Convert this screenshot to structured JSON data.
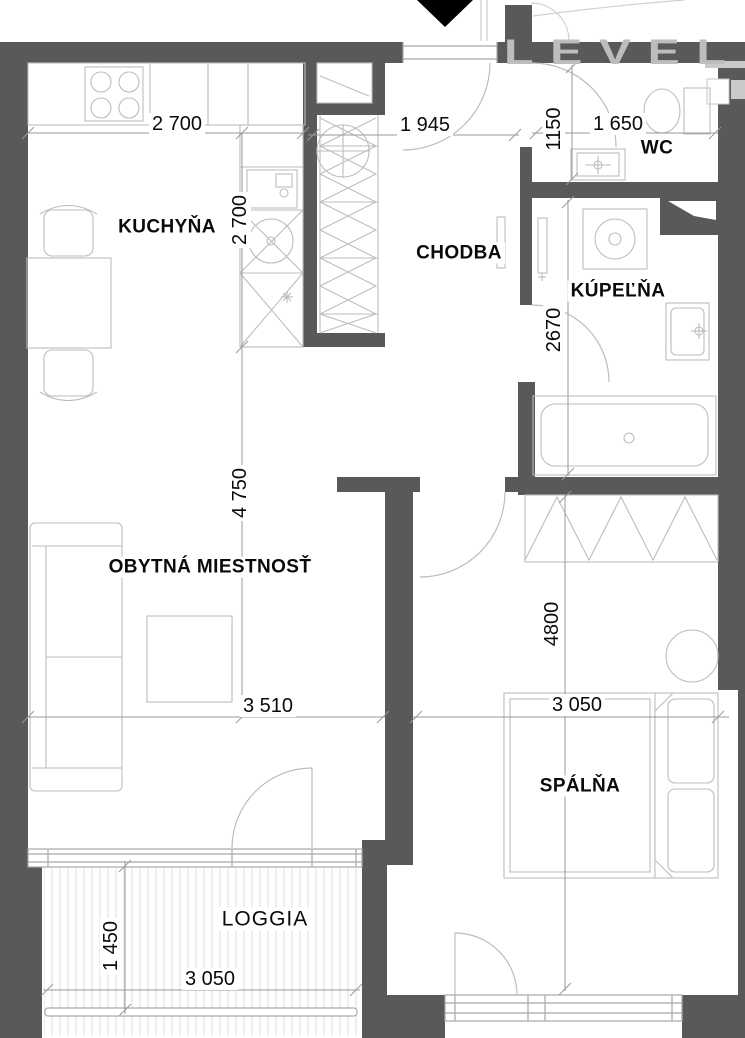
{
  "watermark": {
    "text": "LEVEL"
  },
  "entrance": {
    "marker_shape": "down-triangle"
  },
  "rooms": {
    "kuchyna": {
      "label": "KUCHYŇA"
    },
    "chodba": {
      "label": "CHODBA"
    },
    "wc": {
      "label": "WC"
    },
    "kupelna": {
      "label": "KÚPEĽŇA"
    },
    "obytna_miestnost": {
      "label": "OBYTNÁ MIESTNOSŤ"
    },
    "spalna": {
      "label": "SPÁLŇA"
    },
    "loggia": {
      "label": "LOGGIA"
    }
  },
  "dimensions": {
    "kitchen_width": "2 700",
    "kitchen_depth": "2 700",
    "hallway_width": "1 945",
    "wc_depth": "1150",
    "wc_width": "1 650",
    "bathroom_depth": "2670",
    "living_depth": "4 750",
    "living_width": "3 510",
    "bedroom_depth": "4800",
    "bedroom_width": "3 050",
    "loggia_depth": "1 450",
    "loggia_width": "3 050"
  },
  "colors": {
    "wall": "#595959",
    "furniture_line": "#bdbdbd",
    "window_line": "#a8a8a8",
    "dimension_line": "#9a9a9a",
    "hatch": "#dedede",
    "text": "#0a0a0a",
    "watermark": "#bdbdbd",
    "entrance_marker": "#000000"
  }
}
